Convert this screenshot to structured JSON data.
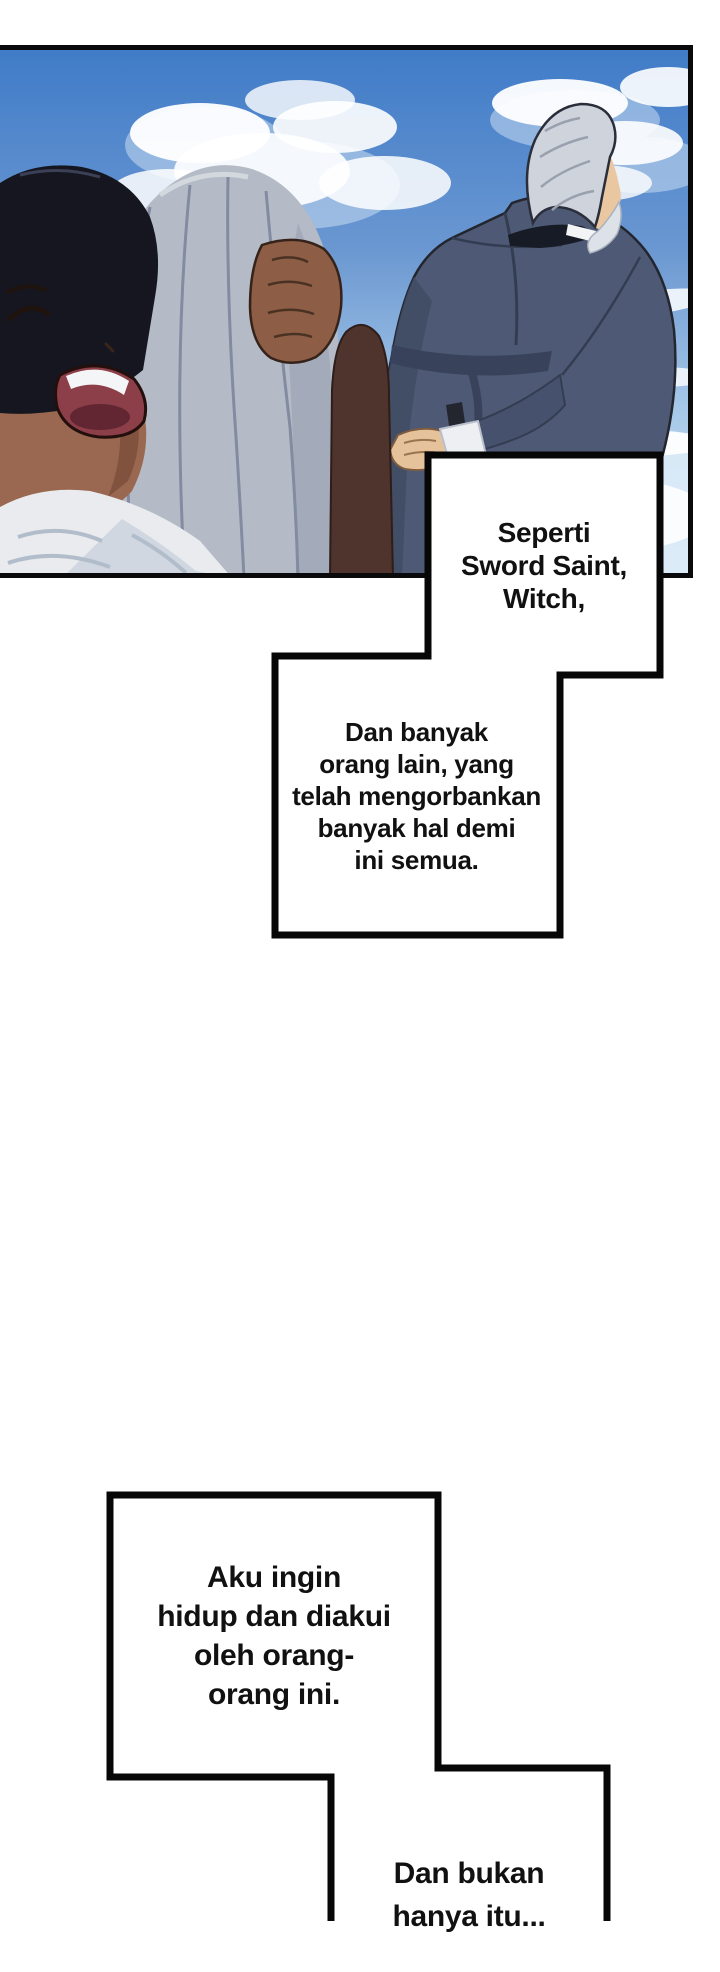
{
  "page": {
    "kind": "webtoon-comic-page",
    "background_color": "#ffffff"
  },
  "panel": {
    "border_color": "#0a0a0c",
    "scene": "sky-with-clouds, dark-haired person embracing gray-haired person, white-haired bearded man in blue coat walking away",
    "colors": {
      "sky_top": "#3f7bc8",
      "sky_mid": "#6a97d1",
      "sky_bottom": "#d9e9f5",
      "cloud": "#ffffff",
      "coat": "#4e5a75",
      "coat_shadow": "#414c64",
      "old_man_hair": "#ced3dc",
      "skin_light": "#e9c7a0",
      "beard": "#dde2e8",
      "gray_hair": "#b5bbc6",
      "gray_hair_strand": "#828ba0",
      "dark_hair": "#15161f",
      "skin_dark": "#9a6850",
      "mouth_interior": "#8c3e49",
      "teeth": "#f4f5f6",
      "white_garment": "#e9ebee"
    }
  },
  "captions": {
    "fill_color": "#ffffff",
    "border_color": "#070708",
    "text_color": "#111111",
    "box1": {
      "lines": [
        "Seperti",
        "Sword Saint,",
        "Witch,"
      ]
    },
    "box2": {
      "lines": [
        "Dan banyak",
        "orang lain, yang",
        "telah mengorbankan",
        "banyak hal demi",
        "ini semua."
      ]
    },
    "box3": {
      "lines": [
        "Aku ingin",
        "hidup dan diakui",
        "oleh orang-",
        "orang ini."
      ]
    },
    "box4": {
      "lines": [
        "Dan bukan",
        "hanya itu..."
      ]
    }
  }
}
